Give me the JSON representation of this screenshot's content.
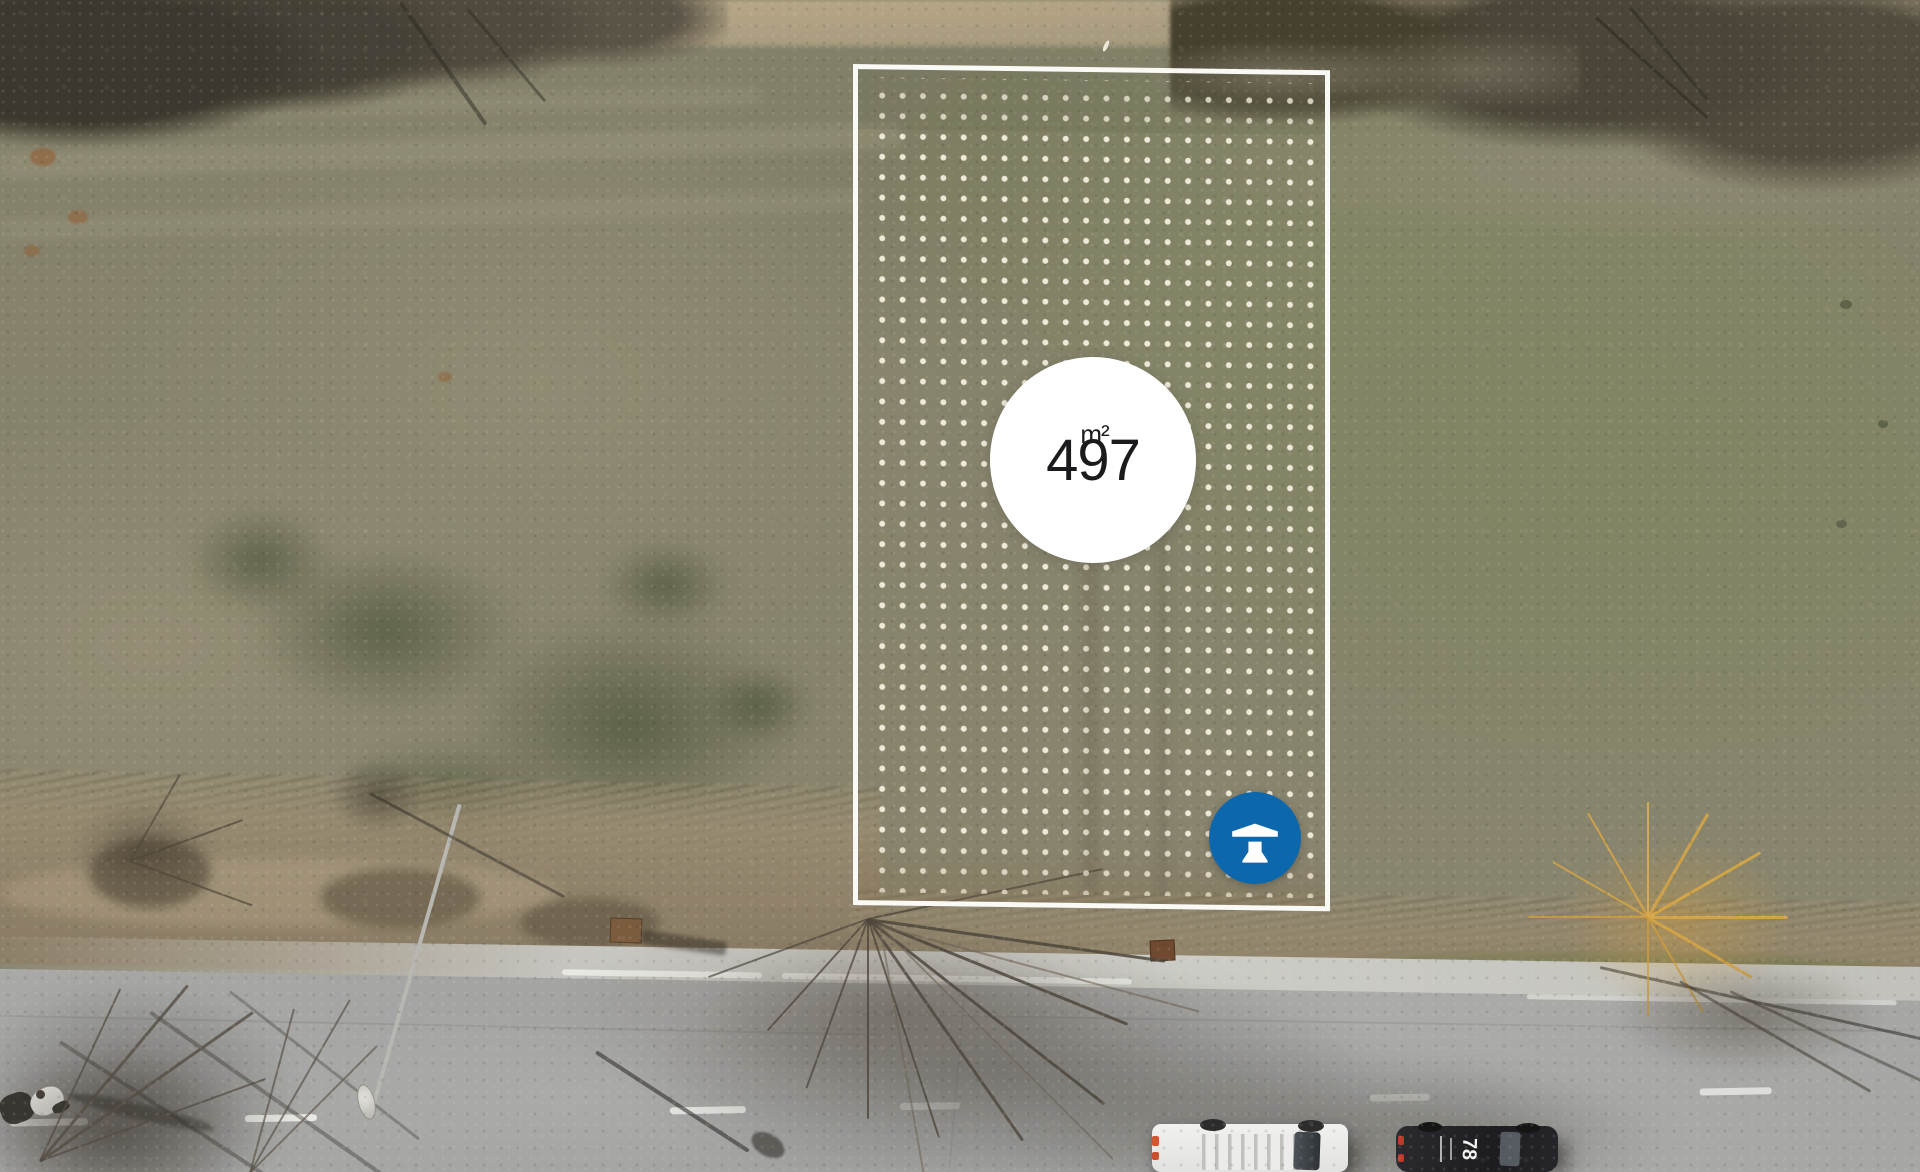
{
  "scene": {
    "kind": "aerial-drone-photo",
    "subject": "vacant building plot outlined beside a road"
  },
  "plot_marker": {
    "area_value": "497",
    "area_unit": "m²"
  },
  "vehicles": {
    "car_roof_marking": "78"
  },
  "logo": {
    "name": "agency-logo",
    "glyph": "roof-and-pillar monogram",
    "color": "#0d67ad"
  },
  "colors": {
    "plot_border": "#fdfdfa",
    "plot_dots": "#f2ecdb",
    "badge_bg": "#ffffff",
    "badge_text": "#1b1b1d",
    "logo_bg": "#0d67ad"
  }
}
